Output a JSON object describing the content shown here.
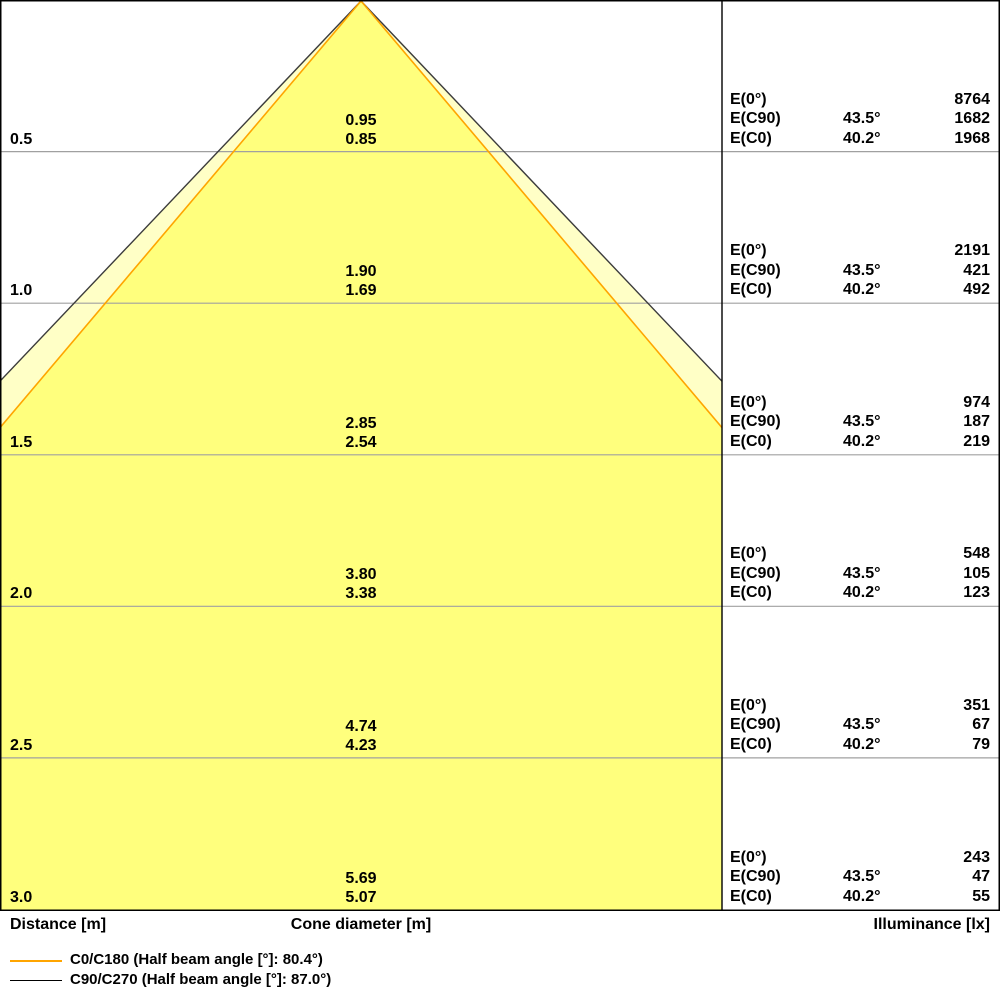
{
  "chart_data": {
    "type": "other",
    "subtype": "luminaire-light-cone-diagram",
    "distances_m": [
      0.5,
      1.0,
      1.5,
      2.0,
      2.5,
      3.0
    ],
    "series": [
      {
        "name": "C90/C270",
        "half_beam_angle_label": "87.0°",
        "angle_column": "43.5°",
        "cone_diameter_m": [
          0.95,
          1.9,
          2.85,
          3.8,
          4.74,
          5.69
        ],
        "illuminance_lx": [
          1682,
          421,
          187,
          105,
          67,
          47
        ],
        "stroke_color": "#3c3c3c",
        "fill_color": "#ffffc6"
      },
      {
        "name": "C0/C180",
        "half_beam_angle_label": "80.4°",
        "angle_column": "40.2°",
        "cone_diameter_m": [
          0.85,
          1.69,
          2.54,
          3.38,
          4.23,
          5.07
        ],
        "illuminance_lx": [
          1968,
          492,
          219,
          123,
          79,
          55
        ],
        "stroke_color": "#ffa500",
        "fill_color": "#ffff7d"
      }
    ],
    "e0_illuminance_lx": [
      8764,
      2191,
      974,
      548,
      351,
      243
    ],
    "xlabel_left": "Distance [m]",
    "xlabel_center": "Cone diameter [m]",
    "xlabel_right": "Illuminance [lx]",
    "gridlines": "horizontal per 0.5 m",
    "legend_position": "bottom-left"
  },
  "labels": {
    "e0": "E(0°)",
    "ec90": "E(C90)",
    "ec0": "E(C0)"
  },
  "rows": [
    {
      "distance": "0.5",
      "d_c90": "0.95",
      "d_c0": "0.85",
      "angle_c90": "43.5°",
      "angle_c0": "40.2°",
      "e0": "8764",
      "e_c90": "1682",
      "e_c0": "1968"
    },
    {
      "distance": "1.0",
      "d_c90": "1.90",
      "d_c0": "1.69",
      "angle_c90": "43.5°",
      "angle_c0": "40.2°",
      "e0": "2191",
      "e_c90": "421",
      "e_c0": "492"
    },
    {
      "distance": "1.5",
      "d_c90": "2.85",
      "d_c0": "2.54",
      "angle_c90": "43.5°",
      "angle_c0": "40.2°",
      "e0": "974",
      "e_c90": "187",
      "e_c0": "219"
    },
    {
      "distance": "2.0",
      "d_c90": "3.80",
      "d_c0": "3.38",
      "angle_c90": "43.5°",
      "angle_c0": "40.2°",
      "e0": "548",
      "e_c90": "105",
      "e_c0": "123"
    },
    {
      "distance": "2.5",
      "d_c90": "4.74",
      "d_c0": "4.23",
      "angle_c90": "43.5°",
      "angle_c0": "40.2°",
      "e0": "351",
      "e_c90": "67",
      "e_c0": "79"
    },
    {
      "distance": "3.0",
      "d_c90": "5.69",
      "d_c0": "5.07",
      "angle_c90": "43.5°",
      "angle_c0": "40.2°",
      "e0": "243",
      "e_c90": "47",
      "e_c0": "55"
    }
  ],
  "footer": {
    "distance": "Distance [m]",
    "cone_diameter": "Cone diameter [m]",
    "illuminance": "Illuminance [lx]"
  },
  "legend": {
    "c0": {
      "label": "C0/C180 (Half beam angle [°]: 80.4°)",
      "color": "#ffa500"
    },
    "c90": {
      "label": "C90/C270 (Half beam angle [°]: 87.0°)",
      "color": "#000000"
    }
  },
  "colors": {
    "outer_cone_fill": "#ffffc6",
    "inner_cone_fill": "#ffff7d",
    "outer_cone_stroke": "#3c3c3c",
    "inner_cone_stroke": "#ffa500",
    "gridline": "#a0a0a0",
    "border": "#000000"
  }
}
